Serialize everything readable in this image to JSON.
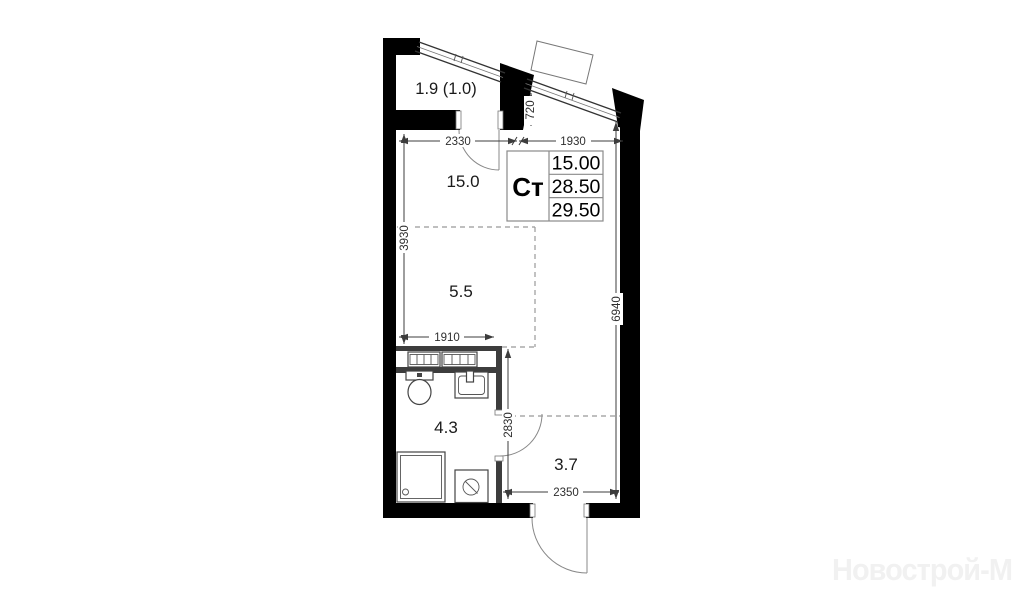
{
  "plan": {
    "table": {
      "type_label": "Ст",
      "rows": [
        "15.00",
        "28.50",
        "29.50"
      ]
    },
    "rooms": [
      {
        "id": "balcony",
        "area_label": "1.9 (1.0)"
      },
      {
        "id": "living-room",
        "area_label": "15.0"
      },
      {
        "id": "kitchen-zone",
        "area_label": "5.5"
      },
      {
        "id": "bathroom",
        "area_label": "4.3"
      },
      {
        "id": "hallway",
        "area_label": "3.7"
      }
    ],
    "dimensions": {
      "d2330": "2330",
      "d1930": "1930",
      "d720": "720",
      "d3930": "3930",
      "d6940": "6940",
      "d1910": "1910",
      "d2830": "2830",
      "d2350": "2350"
    }
  },
  "watermark": {
    "text": "Новострой-М"
  }
}
